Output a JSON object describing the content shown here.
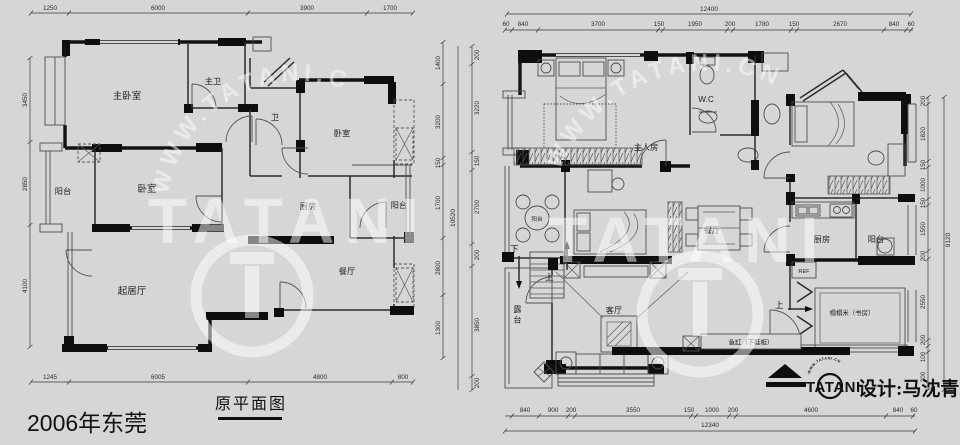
{
  "page": {
    "background": "#d6d6d6",
    "wall_color": "#121212",
    "line_color": "#4d4d4d",
    "watermark_color": "#ffffff"
  },
  "caption": "2006年东莞",
  "brand": {
    "watermark_arc": "WWW.TATANI.CN",
    "watermark_word": "TATANI",
    "logo_word": "TATANI",
    "logo_arc": "WWW.TATANI.CN",
    "designer": "设计:马沈青"
  },
  "left_plan": {
    "title": "原平面图",
    "rooms": {
      "master_bedroom": "主卧室",
      "master_bath": "主卫",
      "bath": "卫",
      "bedroom_right": "卧室",
      "bedroom_lower": "卧室",
      "balcony_left": "阳台",
      "kitchen": "厨房",
      "balcony_right": "阳台",
      "living": "起居厅",
      "dining": "餐厅"
    },
    "dims": {
      "top": [
        "1250",
        "6000",
        "3900",
        "1700"
      ],
      "bottom": [
        "1245",
        "6005",
        "4800",
        "800"
      ],
      "left": [
        "3450",
        "2850",
        "4100"
      ],
      "right_inner": [
        "1400",
        "3200",
        "150",
        "1700",
        "2800",
        "1300"
      ],
      "right_outer": [
        "200",
        "3220",
        "150",
        "2700",
        "200",
        "3850",
        "200"
      ],
      "right_total": "10520"
    }
  },
  "right_plan": {
    "rooms": {
      "master_bedroom": "主人房",
      "wc": "W.C",
      "balcony_small": "阳台",
      "dining": "餐厅",
      "kitchen": "厨房",
      "balcony_right": "阳台",
      "terrace": "露台",
      "living": "客厅",
      "tatami_study": "榻榻米（书房）",
      "fish_tank": "鱼缸（下鞋柜）",
      "fridge": "REF"
    },
    "nav": {
      "down": "下",
      "up": "上",
      "up_study": "上"
    },
    "dims": {
      "top_total": "12400",
      "top": [
        "60",
        "840",
        "3700",
        "150",
        "1950",
        "200",
        "1780",
        "150",
        "2670",
        "840",
        "60"
      ],
      "bottom": [
        "840",
        "900",
        "200",
        "3550",
        "150",
        "1000",
        "200",
        "4600",
        "840",
        "60"
      ],
      "bottom_total": "12340",
      "right": [
        "200",
        "1820",
        "150",
        "1000",
        "150",
        "1550",
        "200",
        "2550",
        "200",
        "100",
        "200"
      ],
      "right_total": "9120"
    }
  }
}
